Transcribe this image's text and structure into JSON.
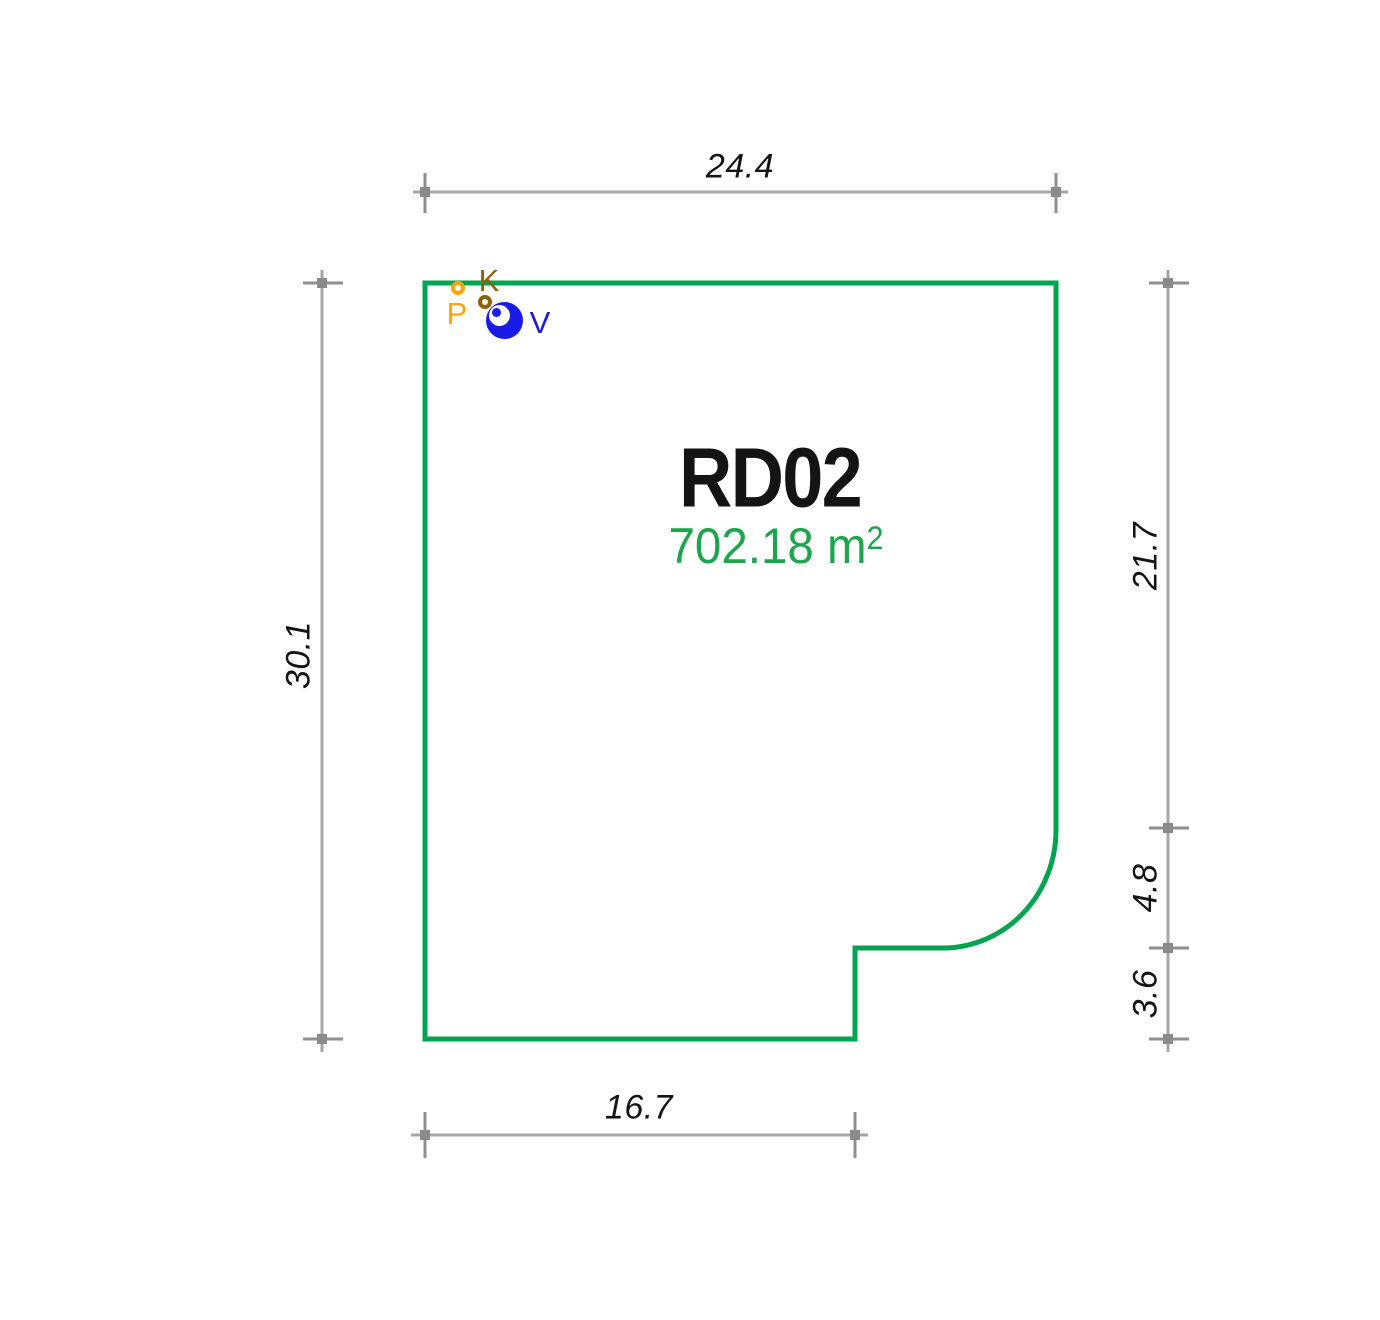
{
  "parcel": {
    "id": "RD02",
    "area_text": "702.18 m",
    "area_sup": "2",
    "outline_color": "#00a350",
    "area_text_color": "#1ca44e"
  },
  "dimensions": {
    "top": {
      "label": "24.4",
      "side": "top"
    },
    "left": {
      "label": "30.1",
      "side": "left"
    },
    "right_upper": {
      "label": "21.7",
      "side": "right"
    },
    "right_middle": {
      "label": "4.8",
      "side": "right"
    },
    "right_lower": {
      "label": "3.6",
      "side": "right"
    },
    "bottom": {
      "label": "16.7",
      "side": "bottom"
    }
  },
  "markers": [
    {
      "id": "P",
      "label": "P",
      "type": "point-marker",
      "color": "#ffa405"
    },
    {
      "id": "K",
      "label": "K",
      "type": "point-marker",
      "color": "#8a6508"
    },
    {
      "id": "V",
      "label": "V",
      "type": "valve-marker",
      "color": "#1b1be8"
    }
  ],
  "colors": {
    "dimension_line": "#a6a6a6",
    "dimension_tick": "#8f8f8f",
    "dimension_text": "#141414",
    "background": "#ffffff"
  }
}
